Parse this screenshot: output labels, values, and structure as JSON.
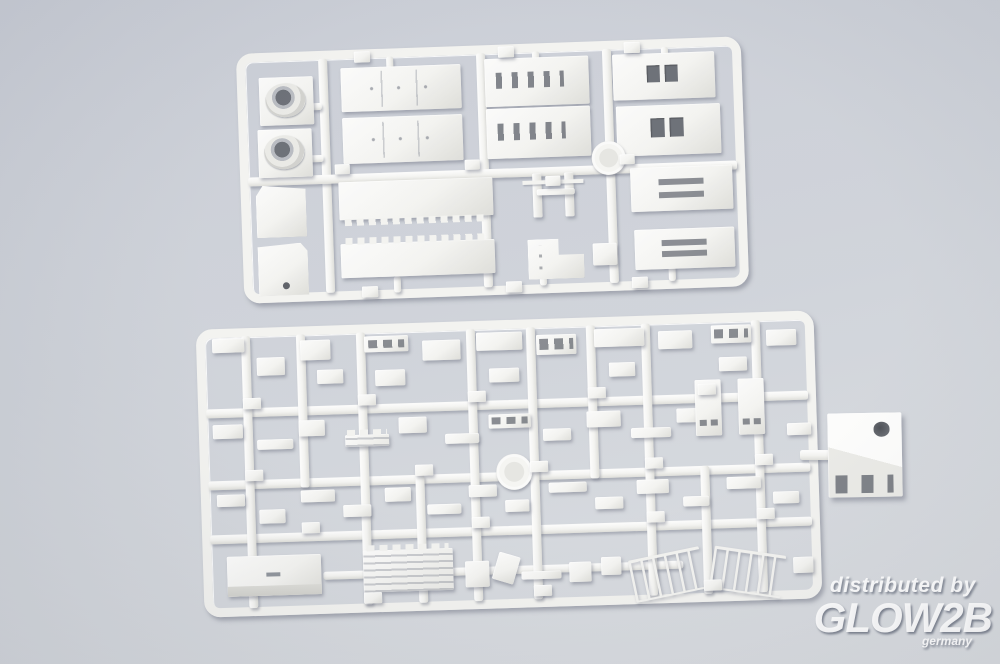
{
  "scene": {
    "width": 1000,
    "height": 664,
    "colors": {
      "bg_top": "#c7cbd4",
      "bg_mid": "#ccd0d7",
      "bg_bottom": "#d8dbdf",
      "plastic": "#f2f2ef",
      "plastic_hi": "#fbfbfa",
      "plastic_lo": "#dcdcd7",
      "window_dark": "#63676f",
      "watermark": "#ffffff"
    }
  },
  "watermark": {
    "line1": "distributed by",
    "line2": "GLOW2B",
    "line3": "germany"
  },
  "sprues": [
    {
      "name": "sprue-top",
      "x": 240,
      "y": 45,
      "w": 505,
      "h": 250,
      "rot": -2,
      "runners": [
        [
          82,
          8,
          9,
          234
        ],
        [
          240,
          8,
          9,
          234
        ],
        [
          366,
          8,
          9,
          234
        ],
        [
          8,
          124,
          489,
          9
        ],
        [
          60,
          52,
          24,
          7
        ],
        [
          60,
          104,
          24,
          7
        ],
        [
          150,
          8,
          7,
          16
        ],
        [
          296,
          8,
          7,
          14
        ],
        [
          425,
          8,
          7,
          14
        ],
        [
          150,
          228,
          7,
          16
        ],
        [
          296,
          214,
          7,
          28
        ],
        [
          425,
          210,
          7,
          32
        ]
      ],
      "parts": [
        [
          22,
          25,
          54,
          48,
          "funnel"
        ],
        [
          19,
          77,
          54,
          48,
          "funnel"
        ],
        [
          15,
          133,
          50,
          52,
          "wedge"
        ],
        [
          15,
          191,
          50,
          52,
          "boxdot"
        ],
        [
          104,
          18,
          120,
          44,
          "panels"
        ],
        [
          104,
          68,
          120,
          46,
          "panels"
        ],
        [
          98,
          132,
          154,
          38,
          "notchdown"
        ],
        [
          98,
          194,
          154,
          34,
          "notchup"
        ],
        [
          248,
          14,
          104,
          48,
          "windows4"
        ],
        [
          248,
          64,
          104,
          50,
          "windows4"
        ],
        [
          292,
          130,
          9,
          44,
          "mast"
        ],
        [
          324,
          130,
          9,
          44,
          "mast"
        ],
        [
          296,
          146,
          38,
          6,
          "thin"
        ],
        [
          285,
          196,
          56,
          40,
          "lshape"
        ],
        [
          350,
          202,
          24,
          22,
          "plain"
        ],
        [
          376,
          14,
          102,
          46,
          "windows2"
        ],
        [
          378,
          66,
          104,
          50,
          "windows2"
        ],
        [
          390,
          128,
          102,
          44,
          "slots2"
        ],
        [
          392,
          190,
          100,
          40,
          "slots2"
        ],
        [
          352,
          100,
          34,
          34,
          "disc"
        ],
        [
          118,
          2,
          16,
          11,
          "tab"
        ],
        [
          262,
          2,
          16,
          11,
          "tab"
        ],
        [
          388,
          2,
          16,
          11,
          "tab"
        ],
        [
          95,
          114,
          15,
          10,
          "tab"
        ],
        [
          225,
          114,
          15,
          10,
          "tab"
        ],
        [
          305,
          133,
          15,
          10,
          "tab"
        ],
        [
          380,
          114,
          15,
          10,
          "tab"
        ],
        [
          118,
          237,
          16,
          11,
          "tab"
        ],
        [
          262,
          237,
          16,
          11,
          "tab"
        ],
        [
          388,
          237,
          16,
          11,
          "tab"
        ]
      ]
    },
    {
      "name": "sprue-bottom",
      "x": 200,
      "y": 320,
      "w": 618,
      "h": 288,
      "rot": -1.8,
      "runners": [
        [
          8,
          80,
          602,
          9
        ],
        [
          8,
          152,
          602,
          9
        ],
        [
          8,
          206,
          602,
          9
        ],
        [
          120,
          246,
          360,
          8
        ],
        [
          45,
          8,
          9,
          272
        ],
        [
          160,
          8,
          9,
          272
        ],
        [
          270,
          8,
          9,
          272
        ],
        [
          330,
          8,
          9,
          272
        ],
        [
          445,
          8,
          9,
          272
        ],
        [
          555,
          8,
          9,
          272
        ],
        [
          100,
          8,
          9,
          153
        ],
        [
          390,
          8,
          9,
          153
        ],
        [
          215,
          152,
          9,
          128
        ],
        [
          500,
          152,
          9,
          128
        ]
      ],
      "parts": [
        [
          16,
          10,
          32,
          14,
          "plain"
        ],
        [
          60,
          30,
          28,
          18,
          "plain"
        ],
        [
          104,
          14,
          30,
          20,
          "plain"
        ],
        [
          120,
          44,
          26,
          14,
          "tab"
        ],
        [
          168,
          12,
          44,
          16,
          "windows3"
        ],
        [
          178,
          46,
          30,
          16,
          "plain"
        ],
        [
          226,
          18,
          38,
          20,
          "plain"
        ],
        [
          280,
          12,
          46,
          18,
          "plain"
        ],
        [
          292,
          48,
          30,
          14,
          "plain"
        ],
        [
          340,
          16,
          40,
          20,
          "windows3"
        ],
        [
          398,
          12,
          50,
          18,
          "plain"
        ],
        [
          412,
          46,
          26,
          14,
          "tab"
        ],
        [
          462,
          16,
          34,
          18,
          "plain"
        ],
        [
          515,
          12,
          40,
          18,
          "windows3"
        ],
        [
          522,
          44,
          28,
          14,
          "plain"
        ],
        [
          570,
          18,
          30,
          16,
          "plain"
        ],
        [
          14,
          96,
          30,
          14,
          "plain"
        ],
        [
          58,
          112,
          36,
          10,
          "thin"
        ],
        [
          100,
          94,
          26,
          16,
          "plain"
        ],
        [
          146,
          110,
          44,
          12,
          "ladder"
        ],
        [
          200,
          94,
          28,
          16,
          "plain"
        ],
        [
          246,
          112,
          34,
          10,
          "thin"
        ],
        [
          290,
          94,
          42,
          14,
          "windows3"
        ],
        [
          344,
          110,
          28,
          12,
          "plain"
        ],
        [
          388,
          94,
          34,
          16,
          "plain"
        ],
        [
          432,
          112,
          40,
          10,
          "thin"
        ],
        [
          478,
          94,
          26,
          14,
          "plain"
        ],
        [
          497,
          66,
          26,
          56,
          "vslots"
        ],
        [
          540,
          66,
          26,
          56,
          "vslots"
        ],
        [
          588,
          112,
          24,
          12,
          "plain"
        ],
        [
          16,
          166,
          28,
          12,
          "plain"
        ],
        [
          58,
          182,
          26,
          14,
          "plain"
        ],
        [
          100,
          164,
          34,
          12,
          "plain"
        ],
        [
          142,
          180,
          28,
          12,
          "plain"
        ],
        [
          184,
          164,
          26,
          14,
          "plain"
        ],
        [
          226,
          182,
          34,
          10,
          "thin"
        ],
        [
          268,
          164,
          28,
          12,
          "plain"
        ],
        [
          304,
          180,
          24,
          12,
          "plain"
        ],
        [
          296,
          134,
          36,
          36,
          "disc"
        ],
        [
          348,
          164,
          38,
          10,
          "thin"
        ],
        [
          394,
          180,
          28,
          12,
          "plain"
        ],
        [
          436,
          164,
          32,
          14,
          "plain"
        ],
        [
          482,
          182,
          26,
          10,
          "thin"
        ],
        [
          526,
          164,
          34,
          12,
          "plain"
        ],
        [
          572,
          180,
          26,
          12,
          "plain"
        ],
        [
          24,
          228,
          94,
          40,
          "block3d"
        ],
        [
          160,
          226,
          90,
          42,
          "ladder"
        ],
        [
          262,
          240,
          24,
          26,
          "plain"
        ],
        [
          292,
          234,
          22,
          28,
          "plain",
          18
        ],
        [
          318,
          252,
          40,
          8,
          "thin"
        ],
        [
          366,
          244,
          22,
          20,
          "plain"
        ],
        [
          398,
          240,
          20,
          18,
          "plain"
        ],
        [
          428,
          238,
          72,
          38,
          "railing",
          -10
        ],
        [
          508,
          238,
          72,
          38,
          "railing",
          10
        ],
        [
          590,
          246,
          20,
          16,
          "plain"
        ],
        [
          45,
          70,
          18,
          11,
          "tab"
        ],
        [
          160,
          70,
          18,
          11,
          "tab"
        ],
        [
          270,
          70,
          18,
          11,
          "tab"
        ],
        [
          390,
          70,
          18,
          11,
          "tab"
        ],
        [
          500,
          70,
          18,
          11,
          "tab"
        ],
        [
          45,
          142,
          18,
          11,
          "tab"
        ],
        [
          215,
          142,
          18,
          11,
          "tab"
        ],
        [
          330,
          142,
          18,
          11,
          "tab"
        ],
        [
          445,
          142,
          18,
          11,
          "tab"
        ],
        [
          555,
          142,
          18,
          11,
          "tab"
        ],
        [
          100,
          196,
          18,
          11,
          "tab"
        ],
        [
          270,
          196,
          18,
          11,
          "tab"
        ],
        [
          445,
          196,
          18,
          11,
          "tab"
        ],
        [
          555,
          196,
          18,
          11,
          "tab"
        ],
        [
          160,
          268,
          18,
          11,
          "tab"
        ],
        [
          330,
          266,
          18,
          11,
          "tab"
        ],
        [
          500,
          266,
          18,
          11,
          "tab"
        ]
      ]
    }
  ],
  "floaters": [
    {
      "x": 800,
      "y": 450,
      "w": 34,
      "h": 10,
      "t": "runner"
    },
    {
      "x": 828,
      "y": 413,
      "w": 74,
      "h": 84,
      "t": "holebox",
      "r": -1
    }
  ]
}
